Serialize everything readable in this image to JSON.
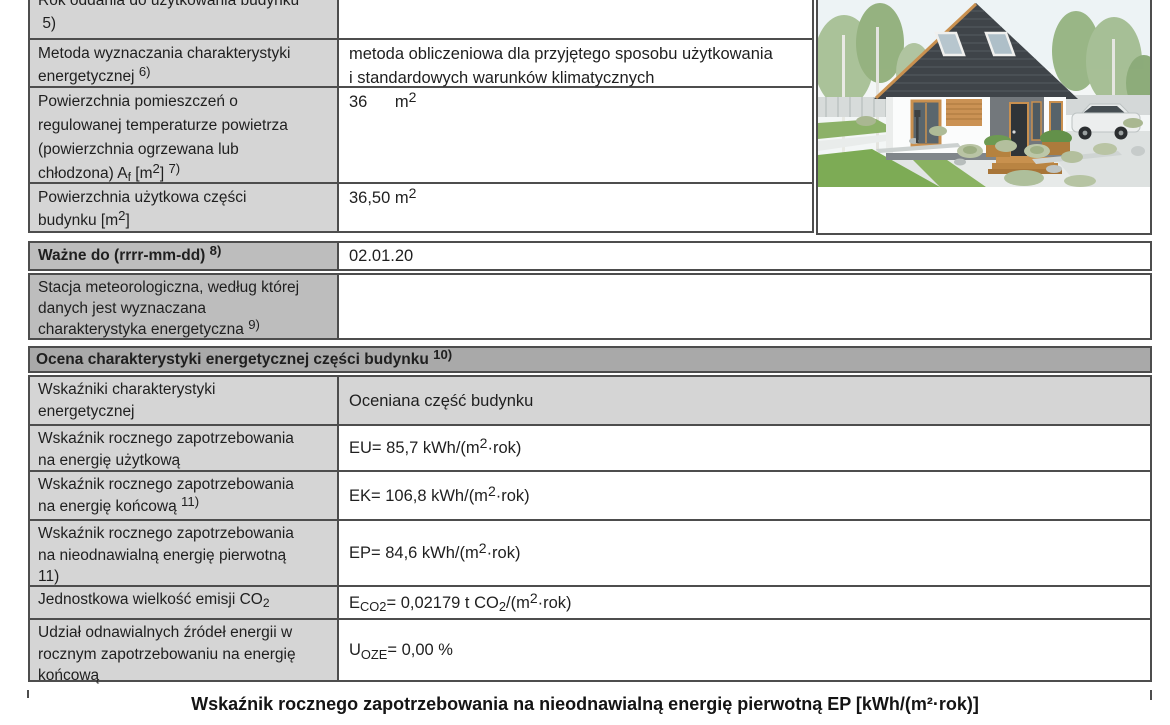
{
  "colors": {
    "label_bg": "#d5d5d5",
    "highlight_label_bg": "#bdbdbd",
    "section_header_bg": "#a9a9a9",
    "border": "#4d4d4d",
    "value_bg": "#ffffff"
  },
  "info_table": {
    "rows": [
      {
        "label": "Rok oddania do użytkowania budynku\n 5)",
        "value": ""
      },
      {
        "label": "Metoda wyznaczania charakterystyki\nenergetycznej ^{6)}",
        "value": "metoda obliczeniowa dla przyjętego sposobu użytkowania\ni standardowych warunków klimatycznych"
      },
      {
        "label": "Powierzchnia pomieszczeń o\nregulowanej temperaturze powietrza\n(powierzchnia ogrzewana lub\nchłodzona) A_{f} [m^{2}] ^{7)}",
        "value": "36      m^{2}"
      },
      {
        "label": "Powierzchnia użytkowa części\nbudynku [m^{2}]",
        "value": "36,50 m^{2}"
      }
    ]
  },
  "validity_row": {
    "label": "Ważne do (rrrr-mm-dd) ^{8)}",
    "value": "02.01.20"
  },
  "station_row": {
    "label": "Stacja meteorologiczna, według której\ndanych jest wyznaczana\ncharakterystyka energetyczna ^{9)}",
    "value": ""
  },
  "assessment_section": {
    "header": "Ocena charakterystyki energetycznej części budynku ^{10)}",
    "rows": [
      {
        "label": "Wskaźniki charakterystyki\nenergetycznej",
        "value": "Oceniana część budynku"
      },
      {
        "label": "Wskaźnik rocznego zapotrzebowania\nna energię użytkową",
        "value": "EU= 85,7 kWh/(m^{2}·rok)"
      },
      {
        "label": "Wskaźnik rocznego zapotrzebowania\nna energię końcową ^{11)}",
        "value": "EK= 106,8 kWh/(m^{2}·rok)"
      },
      {
        "label": "Wskaźnik rocznego zapotrzebowania\nna nieodnawialną energię pierwotną\n11)",
        "value": "EP= 84,6 kWh/(m^{2}·rok)"
      },
      {
        "label": "Jednostkowa wielkość emisji CO_{2}",
        "value": "E_{CO2}= 0,02179 t CO_{2}/(m^{2}·rok)"
      },
      {
        "label": "Udział odnawialnych źródeł energii w\nrocznym zapotrzebowaniu na energię\nkońcową",
        "value": "U_{OZE}= 0,00 %"
      }
    ]
  },
  "footer": {
    "ep_scale_title": "Wskaźnik rocznego zapotrzebowania na nieodnawialną energię pierwotną EP [kWh/(m²·rok)]"
  }
}
